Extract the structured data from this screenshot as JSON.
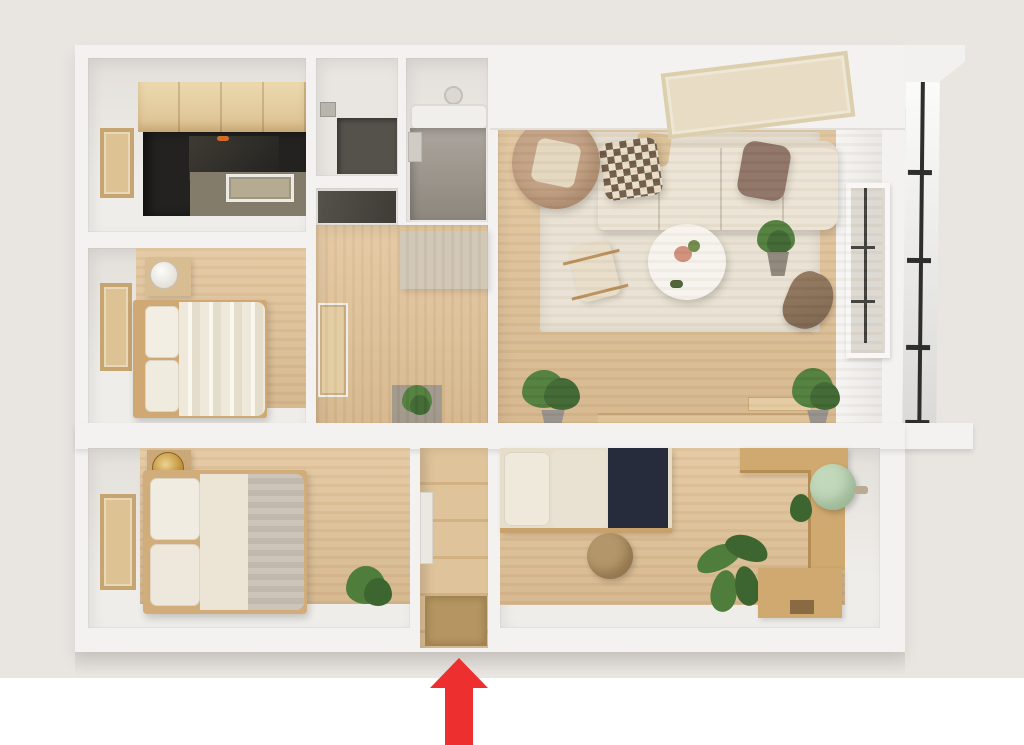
{
  "scene": {
    "type": "3d-top-down-floor-plan-render",
    "annotation": "red arrow at bottom center pointing up toward apartment entrance"
  },
  "annotation": {
    "arrow_color": "#ee2f2f"
  },
  "palette": {
    "background": "#e9e6e2",
    "bottom_band": "#ffffff",
    "wall": "#f3f2f0",
    "wall_face": "#e6e3de",
    "wood_floor": "#ddc098",
    "plank_wall": "#dcc096",
    "rug": "#e8e1d3",
    "sofa": "#ebe3d4",
    "pillow_brown": "#8d7264",
    "armchair_tan": "#c3a184",
    "table_white": "#f7f4ee",
    "counter_dark": "#232220",
    "island_top": "#837c6a",
    "cabinet_wood": "#e4cda1",
    "tile_gray": "#a19b93",
    "tile_dark": "#55514b",
    "bed_cream": "#efe9dc",
    "throw_gray": "#c9c1b5",
    "navy_blanket": "#262c3c",
    "mint_chair": "#c2d8ba",
    "desk_wood": "#cfa96f",
    "ottoman_tan": "#b3966a",
    "doormat": "#b59662",
    "hall_counter": "#cfc6b5",
    "gold_lamp": "#c79a44",
    "plant_green": "#4f7d3c",
    "plant_dark": "#3c6530",
    "pot_gray": "#95908a",
    "railing_black": "#2e2e2c",
    "glass": "#dcd8d1",
    "mullion": "#3d3c39"
  },
  "rooms": [
    {
      "id": "kitchen"
    },
    {
      "id": "utility-room"
    },
    {
      "id": "storage-nook"
    },
    {
      "id": "bathroom"
    },
    {
      "id": "hallway"
    },
    {
      "id": "living-room"
    },
    {
      "id": "bedroom-middle-left"
    },
    {
      "id": "bedroom-bottom-left"
    },
    {
      "id": "entrance-hall"
    },
    {
      "id": "bedroom-bottom-right"
    },
    {
      "id": "balcony"
    }
  ],
  "furniture": [
    "kitchen-cabinets",
    "kitchen-counter",
    "cooktop",
    "sofa",
    "checkered-pillow",
    "brown-pillow",
    "swivel-armchair",
    "coffee-table",
    "side-chair",
    "area-rug",
    "skylight-panel",
    "window",
    "bed-striped",
    "bed-gray-throw",
    "bed-navy",
    "nightstand-lamp",
    "gold-lamp",
    "wall-frames",
    "l-shaped-desk",
    "mint-ball-chair",
    "round-ottoman",
    "palm-plant",
    "potted-plants",
    "doormat"
  ]
}
